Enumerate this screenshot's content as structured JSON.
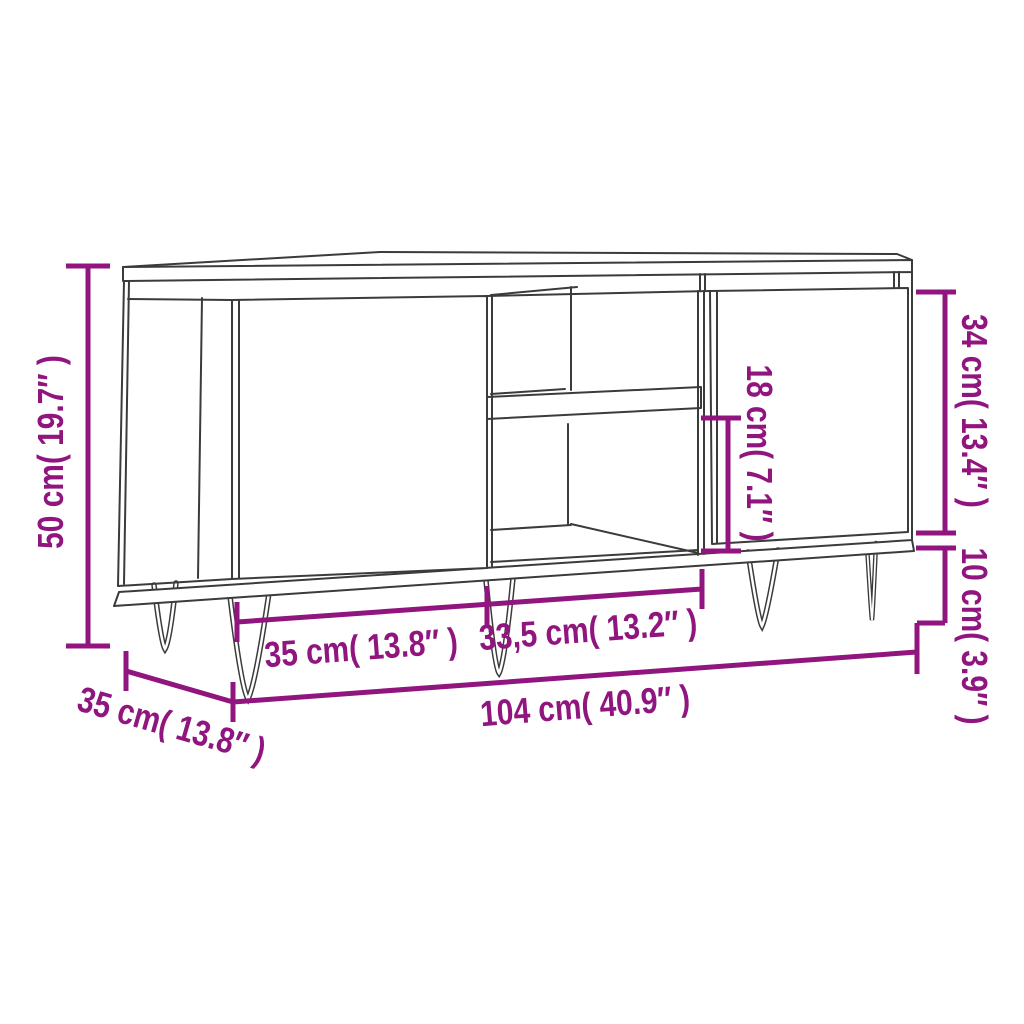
{
  "diagram": {
    "title": "TV cabinet dimension drawing",
    "style": {
      "dimension_color": "#90157F",
      "outline_color": "#3B3B3B",
      "background": "#FFFFFF"
    },
    "dimensions": {
      "overall_height": {
        "label": "50 cm( 19.7″ )"
      },
      "body_height": {
        "label": "34 cm( 13.4″ )"
      },
      "leg_height": {
        "label": "10 cm( 3.9″ )"
      },
      "compartment_height": {
        "label": "18 cm( 7.1″ )"
      },
      "left_door_width": {
        "label": "35 cm( 13.8″ )"
      },
      "middle_section_width": {
        "label": "33,5 cm( 13.2″ )"
      },
      "overall_width": {
        "label": "104 cm( 40.9″ )"
      },
      "depth": {
        "label": "35 cm( 13.8″ )"
      }
    }
  }
}
